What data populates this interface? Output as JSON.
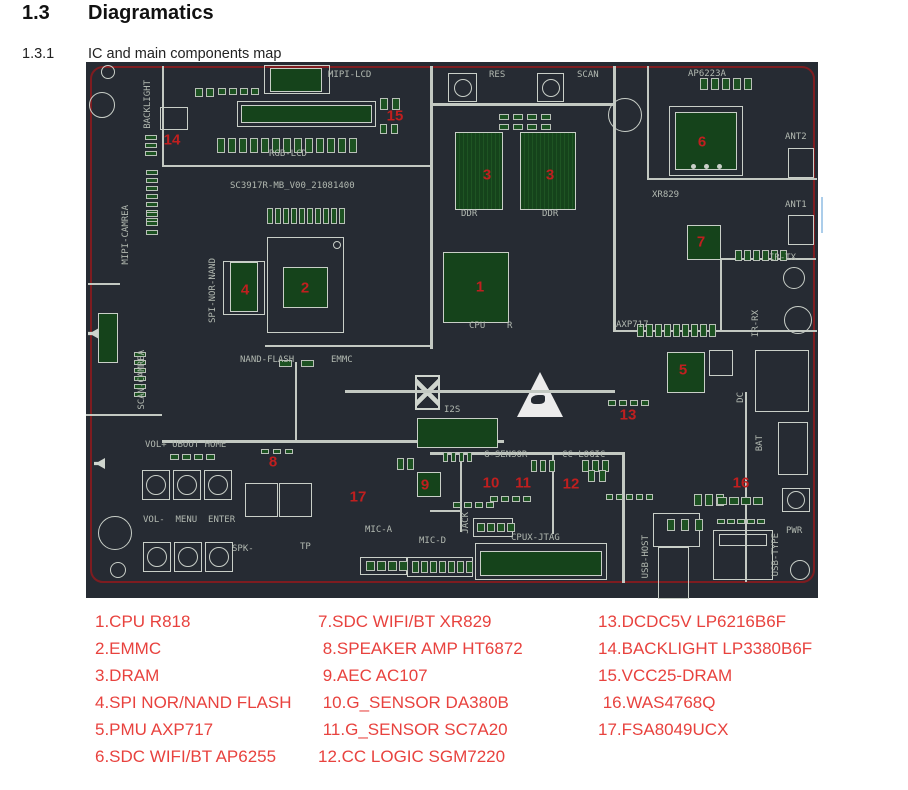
{
  "page": {
    "section_number": "1.3",
    "section_title": "Diagramatics",
    "subsection_number": "1.3.1",
    "subsection_title": "IC and main components map"
  },
  "colors": {
    "board_bg": "#262b33",
    "board_outline_red": "#7e1c20",
    "silkscreen": "#b2b9b1",
    "trace_white": "#c3c9c2",
    "chip_green": "#15431b",
    "pad_green": "#1d5222",
    "component_number_red": "#c01f1f",
    "legend_red": "#e8423e",
    "artifact_blue": "#abcdea"
  },
  "board": {
    "lines": [
      [
        76,
        4,
        2,
        101
      ],
      [
        76,
        103,
        270,
        2
      ],
      [
        344,
        4,
        3,
        283
      ],
      [
        344,
        41,
        186,
        3
      ],
      [
        527,
        4,
        3,
        266
      ],
      [
        179,
        283,
        168,
        2
      ],
      [
        209,
        300,
        2,
        80
      ],
      [
        76,
        378,
        342,
        3
      ],
      [
        344,
        390,
        194,
        3
      ],
      [
        536,
        390,
        3,
        131
      ],
      [
        374,
        392,
        2,
        78
      ],
      [
        344,
        448,
        32,
        2
      ],
      [
        466,
        390,
        2,
        82
      ],
      [
        561,
        116,
        170,
        2
      ],
      [
        561,
        4,
        2,
        112
      ],
      [
        634,
        196,
        96,
        2
      ],
      [
        634,
        196,
        2,
        74
      ],
      [
        527,
        268,
        204,
        2
      ],
      [
        259,
        328,
        270,
        3
      ],
      [
        659,
        330,
        2,
        190
      ],
      [
        0,
        352,
        76,
        2
      ],
      [
        2,
        221,
        32,
        2
      ]
    ],
    "chips": [
      [
        369,
        70,
        48,
        78,
        1
      ],
      [
        434,
        70,
        56,
        78,
        1
      ],
      [
        357,
        190,
        66,
        71,
        0
      ],
      [
        197,
        205,
        45,
        41,
        0
      ],
      [
        144,
        200,
        28,
        50,
        0
      ],
      [
        589,
        50,
        62,
        58,
        0
      ],
      [
        601,
        163,
        34,
        35,
        0
      ],
      [
        581,
        290,
        38,
        41,
        0
      ],
      [
        331,
        410,
        24,
        25,
        0
      ],
      [
        331,
        356,
        81,
        30,
        0
      ],
      [
        394,
        489,
        122,
        25,
        0
      ],
      [
        184,
        6,
        52,
        24,
        0
      ],
      [
        155,
        43,
        131,
        18,
        0
      ],
      [
        12,
        251,
        20,
        50,
        0
      ]
    ],
    "outlines": [
      [
        181,
        175,
        77,
        96
      ],
      [
        137,
        199,
        42,
        54
      ],
      [
        583,
        44,
        74,
        70
      ],
      [
        151,
        39,
        139,
        26
      ],
      [
        178,
        3,
        66,
        29
      ],
      [
        389,
        481,
        132,
        37
      ],
      [
        274,
        495,
        47,
        18
      ],
      [
        387,
        456,
        40,
        19
      ],
      [
        321,
        495,
        66,
        20
      ],
      [
        567,
        451,
        47,
        34
      ],
      [
        572,
        485,
        31,
        52
      ],
      [
        627,
        468,
        60,
        50
      ],
      [
        633,
        472,
        48,
        12
      ],
      [
        692,
        360,
        30,
        53
      ],
      [
        669,
        288,
        54,
        62
      ],
      [
        159,
        421,
        33,
        34
      ],
      [
        193,
        421,
        33,
        34
      ],
      [
        74,
        45,
        28,
        23
      ],
      [
        702,
        86,
        26,
        30
      ],
      [
        702,
        153,
        26,
        30
      ],
      [
        623,
        288,
        24,
        26
      ]
    ],
    "pads": [
      [
        131,
        76,
        13,
        8,
        15,
        3,
        0
      ],
      [
        181,
        146,
        10,
        6,
        16,
        2,
        0
      ],
      [
        60,
        108,
        7,
        12,
        5,
        0,
        3
      ],
      [
        48,
        290,
        6,
        12,
        5,
        0,
        3
      ],
      [
        193,
        298,
        2,
        13,
        7,
        9,
        0
      ],
      [
        551,
        262,
        9,
        7,
        13,
        2,
        0
      ],
      [
        614,
        16,
        5,
        8,
        12,
        3,
        0
      ],
      [
        649,
        188,
        6,
        7,
        11,
        2,
        0
      ],
      [
        294,
        36,
        2,
        8,
        12,
        4,
        0
      ],
      [
        294,
        62,
        2,
        7,
        10,
        4,
        0
      ],
      [
        109,
        26,
        2,
        8,
        9,
        3,
        0
      ],
      [
        132,
        26,
        4,
        8,
        7,
        3,
        0
      ],
      [
        59,
        73,
        3,
        12,
        5,
        0,
        3
      ],
      [
        413,
        52,
        4,
        10,
        6,
        4,
        0
      ],
      [
        413,
        62,
        4,
        10,
        6,
        4,
        0
      ],
      [
        84,
        392,
        4,
        9,
        6,
        3,
        0
      ],
      [
        175,
        387,
        3,
        8,
        5,
        4,
        0
      ],
      [
        311,
        396,
        2,
        7,
        12,
        3,
        0
      ],
      [
        357,
        390,
        4,
        5,
        10,
        3,
        0
      ],
      [
        367,
        440,
        4,
        8,
        6,
        3,
        0
      ],
      [
        404,
        434,
        4,
        8,
        6,
        3,
        0
      ],
      [
        445,
        398,
        3,
        6,
        12,
        3,
        0
      ],
      [
        496,
        398,
        3,
        7,
        12,
        3,
        0
      ],
      [
        520,
        432,
        5,
        7,
        6,
        3,
        0
      ],
      [
        608,
        432,
        3,
        8,
        12,
        3,
        0
      ],
      [
        631,
        435,
        4,
        10,
        8,
        2,
        0
      ],
      [
        631,
        457,
        5,
        8,
        5,
        2,
        0
      ],
      [
        522,
        338,
        4,
        8,
        6,
        3,
        0
      ],
      [
        502,
        408,
        2,
        7,
        12,
        4,
        0
      ],
      [
        391,
        461,
        4,
        8,
        9,
        2,
        0
      ],
      [
        280,
        499,
        4,
        9,
        10,
        2,
        0
      ],
      [
        326,
        499,
        7,
        7,
        12,
        2,
        0
      ],
      [
        581,
        457,
        3,
        8,
        12,
        6,
        0
      ],
      [
        60,
        150,
        3,
        12,
        5,
        0,
        4
      ]
    ],
    "buttons": [
      [
        56,
        408,
        28,
        30,
        10
      ],
      [
        87,
        408,
        28,
        30,
        10
      ],
      [
        118,
        408,
        28,
        30,
        10
      ],
      [
        57,
        480,
        28,
        30,
        10
      ],
      [
        88,
        480,
        28,
        30,
        10
      ],
      [
        119,
        480,
        28,
        30,
        10
      ],
      [
        362,
        11,
        29,
        29,
        9
      ],
      [
        451,
        11,
        27,
        29,
        9
      ],
      [
        696,
        426,
        28,
        24,
        9
      ]
    ],
    "circles": [
      [
        22,
        10,
        7,
        0
      ],
      [
        16,
        43,
        13,
        0
      ],
      [
        539,
        53,
        17,
        0
      ],
      [
        29,
        471,
        17,
        0
      ],
      [
        32,
        508,
        8,
        0
      ],
      [
        708,
        216,
        11,
        0
      ],
      [
        712,
        258,
        14,
        0
      ],
      [
        714,
        508,
        10,
        0
      ],
      [
        607,
        104,
        2.5,
        1
      ],
      [
        620,
        104,
        2.5,
        1
      ],
      [
        633,
        104,
        2.5,
        1
      ],
      [
        251,
        183,
        4,
        0
      ]
    ],
    "labels": [
      {
        "t": "MIPI-LCD",
        "x": 242,
        "y": 8
      },
      {
        "t": "RGB-LCD",
        "x": 183,
        "y": 87
      },
      {
        "t": "SC3917R-MB_V00_21081400",
        "x": 144,
        "y": 119
      },
      {
        "t": "NAND-FLASH",
        "x": 154,
        "y": 293
      },
      {
        "t": "EMMC",
        "x": 245,
        "y": 293
      },
      {
        "t": "CPU",
        "x": 383,
        "y": 259
      },
      {
        "t": "R",
        "x": 421,
        "y": 259
      },
      {
        "t": "DDR",
        "x": 375,
        "y": 147
      },
      {
        "t": "DDR",
        "x": 456,
        "y": 147
      },
      {
        "t": "RES",
        "x": 403,
        "y": 8
      },
      {
        "t": "SCAN",
        "x": 491,
        "y": 8
      },
      {
        "t": "AP6223A",
        "x": 602,
        "y": 7
      },
      {
        "t": "ANT2",
        "x": 699,
        "y": 70
      },
      {
        "t": "ANT1",
        "x": 699,
        "y": 138
      },
      {
        "t": "XR829",
        "x": 566,
        "y": 128
      },
      {
        "t": "IR-TX",
        "x": 683,
        "y": 191
      },
      {
        "t": "AXP717",
        "x": 530,
        "y": 258
      },
      {
        "t": "I2S",
        "x": 358,
        "y": 343
      },
      {
        "t": "G-SENSOR",
        "x": 398,
        "y": 388
      },
      {
        "t": "CC-LOGIC",
        "x": 476,
        "y": 388
      },
      {
        "t": "VOL+ UBOOT HOME",
        "x": 59,
        "y": 378
      },
      {
        "t": "VOL-  MENU  ENTER",
        "x": 57,
        "y": 453
      },
      {
        "t": "SPK-",
        "x": 146,
        "y": 482
      },
      {
        "t": "TP",
        "x": 214,
        "y": 480
      },
      {
        "t": "MIC-A",
        "x": 279,
        "y": 463
      },
      {
        "t": "MIC-D",
        "x": 333,
        "y": 474
      },
      {
        "t": "CPUX-JTAG",
        "x": 425,
        "y": 471
      },
      {
        "t": "PWR",
        "x": 700,
        "y": 464
      },
      {
        "t": "BACKLIGHT",
        "x": 57,
        "y": 18,
        "v": 1
      },
      {
        "t": "MIPI-CAMREA",
        "x": 35,
        "y": 143,
        "v": 1
      },
      {
        "t": "SCAN-CAMREA",
        "x": 51,
        "y": 288,
        "v": 1
      },
      {
        "t": "SPI-NOR-NAND",
        "x": 122,
        "y": 196,
        "v": 1
      },
      {
        "t": "IR-RX",
        "x": 665,
        "y": 248,
        "v": 1
      },
      {
        "t": "JACK",
        "x": 375,
        "y": 450,
        "v": 1
      },
      {
        "t": "USB-HOST",
        "x": 555,
        "y": 473,
        "v": 1
      },
      {
        "t": "USB-TYPE",
        "x": 685,
        "y": 471,
        "v": 1
      },
      {
        "t": "DC",
        "x": 650,
        "y": 330,
        "v": 1
      },
      {
        "t": "BAT",
        "x": 669,
        "y": 373,
        "v": 1
      }
    ],
    "numbers": [
      {
        "n": "1",
        "x": 394,
        "y": 225
      },
      {
        "n": "2",
        "x": 219,
        "y": 226
      },
      {
        "n": "3",
        "x": 401,
        "y": 113
      },
      {
        "n": "3",
        "x": 464,
        "y": 113
      },
      {
        "n": "4",
        "x": 159,
        "y": 228
      },
      {
        "n": "5",
        "x": 597,
        "y": 308
      },
      {
        "n": "6",
        "x": 616,
        "y": 80
      },
      {
        "n": "7",
        "x": 615,
        "y": 180
      },
      {
        "n": "8",
        "x": 187,
        "y": 400
      },
      {
        "n": "9",
        "x": 339,
        "y": 423
      },
      {
        "n": "10",
        "x": 405,
        "y": 421
      },
      {
        "n": "11",
        "x": 437,
        "y": 421
      },
      {
        "n": "12",
        "x": 485,
        "y": 422
      },
      {
        "n": "13",
        "x": 542,
        "y": 353
      },
      {
        "n": "14",
        "x": 86,
        "y": 78
      },
      {
        "n": "15",
        "x": 309,
        "y": 54
      },
      {
        "n": "16",
        "x": 655,
        "y": 421
      },
      {
        "n": "17",
        "x": 272,
        "y": 435
      }
    ]
  },
  "legend": {
    "columns": [
      {
        "x": 95,
        "items": [
          "1.CPU R818",
          "2.EMMC",
          "3.DRAM",
          "4.SPI NOR/NAND FLASH",
          "5.PMU AXP717",
          "6.SDC WIFI/BT AP6255"
        ]
      },
      {
        "x": 318,
        "items": [
          "7.SDC WIFI/BT XR829",
          " 8.SPEAKER AMP HT6872",
          " 9.AEC AC107",
          " 10.G_SENSOR DA380B",
          " 11.G_SENSOR SC7A20",
          "12.CC LOGIC SGM7220"
        ]
      },
      {
        "x": 598,
        "items": [
          "13.DCDC5V LP6216B6F",
          "14.BACKLIGHT LP3380B6F",
          "15.VCC25-DRAM",
          " 16.WAS4768Q",
          "17.FSA8049UCX"
        ]
      }
    ]
  }
}
